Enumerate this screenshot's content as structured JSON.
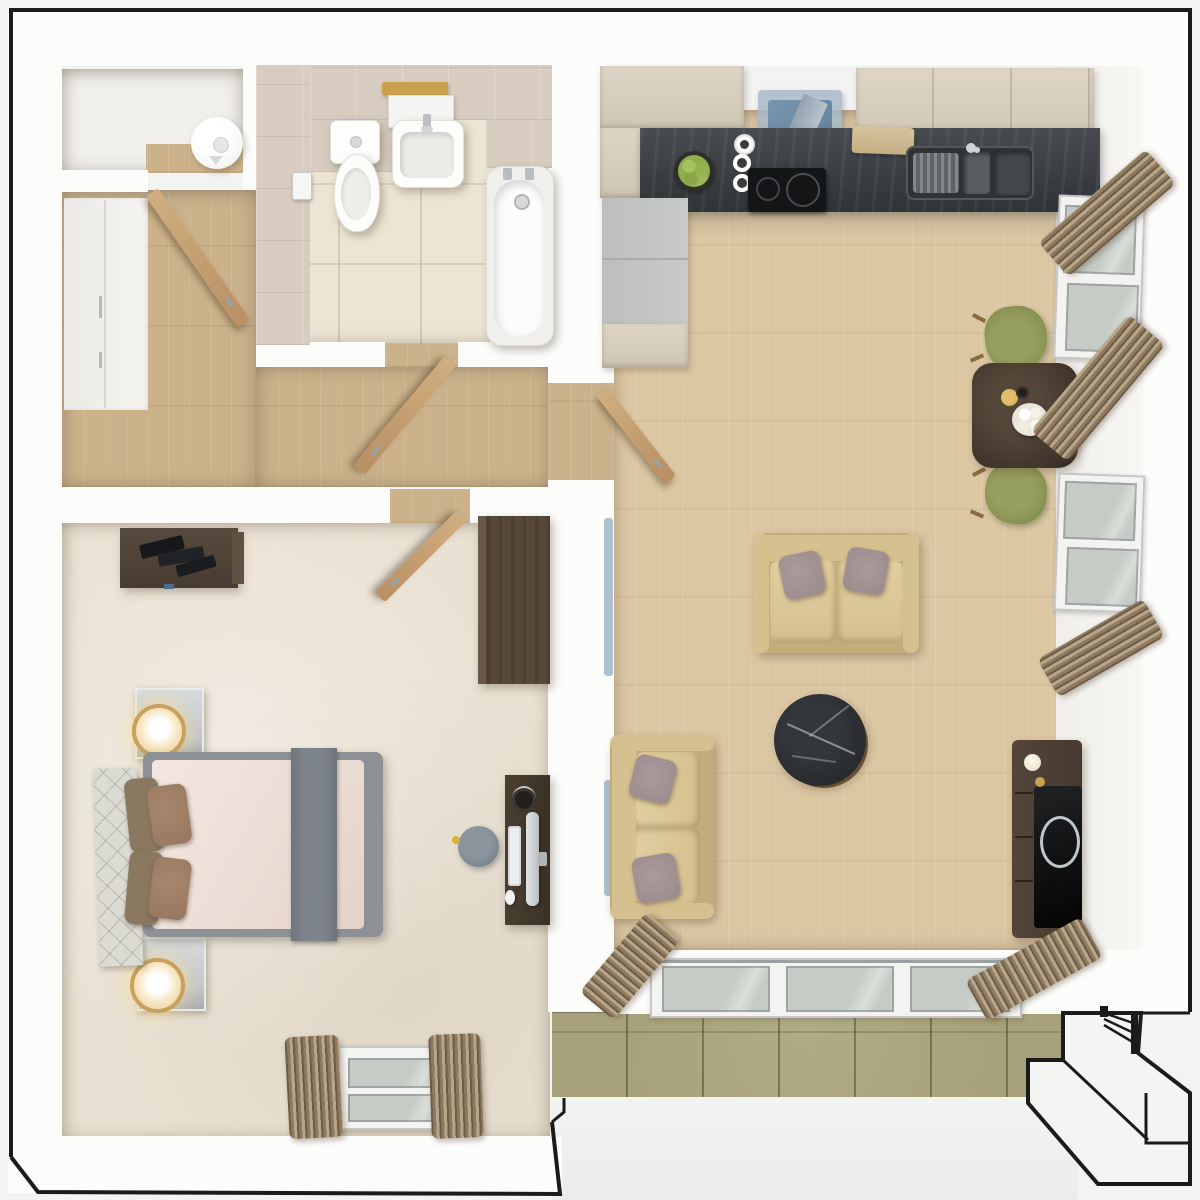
{
  "meta": {
    "title": "3D top-view floor plan of a one-bedroom apartment with balcony",
    "type": "architectural-render",
    "visible_text": ""
  },
  "colors": {
    "bg": "#f3f3f2",
    "wall": "#fcfcfb",
    "outline": "#1b1b1b",
    "wood-light": "#dcc7a3",
    "hall-wood": "#cbb28a",
    "carpet": "#e9e1d3",
    "bath-floor": "#ece5d4",
    "bath-tile": "#d7ccbf",
    "balcony-tile": "#a7a279",
    "balcony-grout": "#807b55",
    "counter": "#484c50",
    "counter-dark": "#303437",
    "cabinet": "#cfc5b4",
    "cabinet-light": "#ddd5c6",
    "fridge": "#c7cac7",
    "hood-blue": "#5f7e9a",
    "hood-glass": "#a9bac8",
    "sofa": "#d5c08f",
    "sofa-dark": "#c2ac7a",
    "sofa-light": "#e0cfa0",
    "pillow-mauve": "#9b8a8b",
    "dining-table": "#3e332a",
    "chair-olive": "#87914f",
    "marble": "#26282b",
    "marble-vein": "#d6d9db",
    "table-rim": "#6d5233",
    "tv-wood": "#46392e",
    "tv-black": "#121315",
    "ring-silver": "#bfc6ca",
    "curtain-a": "#8d7a61",
    "curtain-b": "#b7a687",
    "curtain-c": "#6e5c48",
    "glass": "#c6cbc6",
    "frame-white": "#f3f3f1",
    "blanket": "#eddfd7",
    "runner": "#7e848b",
    "bedframe": "#8d9196",
    "headboard": "#dcdbd3",
    "pillow-brown": "#96765e",
    "pillow-tan": "#8a7861",
    "nightstand": "#c3c6c9",
    "lamp-gold": "#c9a15e",
    "lamp-glow": "#f6e7c4",
    "dresser": "#483c32",
    "wardrobe": "#55473a",
    "desk": "#3a3126",
    "stool": "#76818b",
    "gold": "#c9a14e",
    "radiator": "#aec0cb",
    "door-wood": "#cfae7f",
    "apple": "#8fae4e",
    "heater": "#f5f5f4"
  },
  "rooms": [
    {
      "id": "storage-closet",
      "items": [
        "water-heater",
        "wood-floor-strip"
      ]
    },
    {
      "id": "bathroom",
      "items": [
        "toilet",
        "washbasin",
        "wall-shelf",
        "wooden-tray",
        "bathtub",
        "bath-taps",
        "toilet-roll-holder",
        "tiled-walls",
        "tiled-floor",
        "door-open"
      ]
    },
    {
      "id": "hallway",
      "items": [
        "built-in-wardrobe",
        "wood-floor",
        "closet-door-open",
        "bathroom-door-open"
      ]
    },
    {
      "id": "bedroom",
      "items": [
        "dresser",
        "wardrobe",
        "double-bed",
        "quilted-headboard",
        "bed-runner",
        "pillows",
        "nightstand-with-lamp-x2",
        "desk",
        "computer-monitor",
        "keyboard",
        "mouse",
        "headphones",
        "stool",
        "window",
        "curtains",
        "door-open"
      ]
    },
    {
      "id": "living-kitchen",
      "items": [
        "upper-cabinets",
        "extractor-hood",
        "cooktop",
        "sink",
        "cutting-board",
        "fruit-bowl",
        "cup-stack",
        "fridge",
        "counter",
        "dining-table",
        "candle",
        "flower-vase",
        "olive-chair-x2",
        "sofa-x2",
        "throw-pillows",
        "round-marble-coffee-table",
        "tv-sideboard",
        "radiator-x2",
        "window-x2",
        "curtain-bundles",
        "sliding-glass-doors",
        "entry-door-open"
      ]
    },
    {
      "id": "balcony",
      "items": [
        "olive-floor-tiles",
        "parapet-wall",
        "outdoor-steps",
        "railing"
      ]
    }
  ]
}
